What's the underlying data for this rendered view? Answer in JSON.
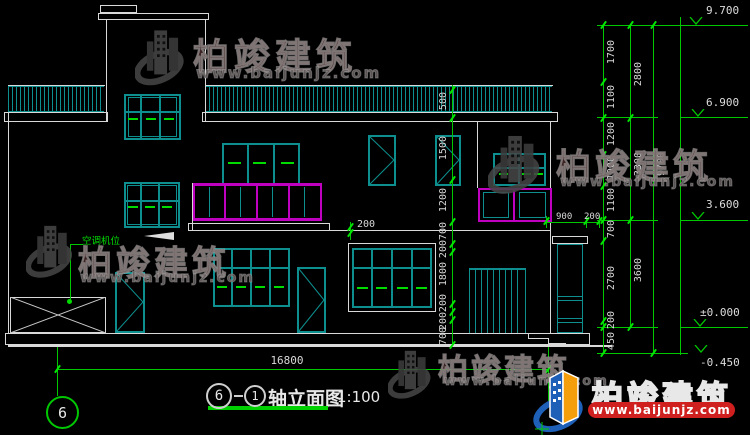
{
  "drawing": {
    "title": {
      "left_axis": "6",
      "right_axis": "1",
      "name": "轴立面图",
      "scale": "1:100"
    },
    "bottom_dim": "16800",
    "grid_marker_left": "6",
    "annotation_ac": "空调机位",
    "levels": {
      "top": "9.700",
      "roof": "6.900",
      "floor2": "3.600",
      "zero": "±0.000",
      "ground": "-0.450"
    },
    "mid_chain": [
      "500",
      "1500",
      "1200",
      "700",
      "200",
      "1800",
      "200",
      "200",
      "700"
    ],
    "right_inner": [
      "1700",
      "1100",
      "1200",
      "1000",
      "1100",
      "700",
      "2700",
      "200",
      "450"
    ],
    "right_outer": [
      "2800",
      "3300",
      "3600"
    ],
    "right_total": "9700",
    "porch_dims": {
      "d900": "900",
      "d200": "200"
    },
    "balcony_dim": "200"
  },
  "watermark": {
    "brand": "柏竣建筑",
    "url": "www.baijunjz.com"
  },
  "colors": {
    "dim_green": "#00C800",
    "window_teal": "#0E8F8F",
    "railing_magenta": "#C000C0",
    "line_white": "#D9D9D9",
    "brand_red": "#CF1F1F",
    "logo_blue": "#1E5FB8",
    "logo_orange": "#F59E0B"
  }
}
